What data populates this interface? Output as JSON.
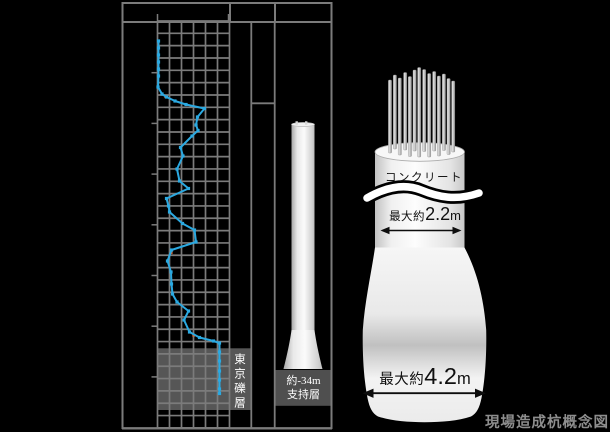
{
  "canvas": {
    "width": 610,
    "height": 432,
    "background": "#000000"
  },
  "colors": {
    "grid_gray": "#7b7b7b",
    "line_blue": "#2BA9E1",
    "red_mark_orange": "#D9622B",
    "layer_band_gray": "#565656",
    "support_box_gray": "#4f4f4f",
    "caption_gray": "#8e8e8e",
    "white": "#ffffff",
    "black": "#000000"
  },
  "boring_log": {
    "grid": {
      "x0": 157.5,
      "x1": 229.5,
      "col_step": 12,
      "y0": 21,
      "y1": 428,
      "row_step": 12.33
    },
    "frame": {
      "lines": [
        [
          122,
          3,
          332,
          3,
          2
        ],
        [
          122,
          22,
          332,
          22,
          2
        ],
        [
          122.5,
          2,
          122.5,
          429,
          2
        ],
        [
          331.5,
          2,
          331.5,
          429,
          2
        ],
        [
          122,
          428.3,
          332,
          428.3,
          2.4
        ],
        [
          230,
          2,
          230,
          22,
          2
        ],
        [
          275,
          2,
          275,
          22,
          2
        ],
        [
          251.3,
          22,
          251.3,
          428,
          1.8
        ],
        [
          274.7,
          22,
          274.7,
          428,
          1.8
        ],
        [
          251.3,
          103.3,
          274.7,
          103.3,
          1.8
        ]
      ],
      "header_ticks_x": [
        157.5,
        228.5
      ],
      "left_ticks_y": [
        72.7,
        123.4,
        174.1,
        224.8,
        275.5,
        326.2,
        376.9
      ]
    },
    "layer_band": {
      "label": "東京礫層",
      "x": 157.5,
      "y": 348.3,
      "w": 93.8,
      "h": 61.7
    },
    "support_box": {
      "line1": "約-34m",
      "line2": "支持層",
      "x": 275,
      "y": 370,
      "w": 56.5,
      "h": 35.8
    },
    "pile_column": {
      "x": 291.5,
      "w": 23,
      "top": 124.5,
      "flare_top": 330,
      "bottom": 369,
      "flare_extra": 8
    }
  },
  "chart_data": {
    "type": "line",
    "title": "",
    "description": "Borehole standard-penetration-test N-value log; depth increases downward, N value increases to the right",
    "x_axis": {
      "label": "",
      "n_value_range": [
        0,
        60
      ],
      "gridline_step_n": 10
    },
    "y_axis": {
      "label": "",
      "depth_increases_down": true,
      "major_tick_interval_m": 5
    },
    "legend": "none",
    "series": [
      {
        "name": "N値",
        "color": "#2BA9E1",
        "points_depth_m_vs_n": [
          [
            1.9,
            0.8
          ],
          [
            2.6,
            0.8
          ],
          [
            3.2,
            0.8
          ],
          [
            3.9,
            0.8
          ],
          [
            4.6,
            0.8
          ],
          [
            5.3,
            0.8
          ],
          [
            6.3,
            0.4
          ],
          [
            7.0,
            3.8
          ],
          [
            7.3,
            7.5
          ],
          [
            7.6,
            14.6
          ],
          [
            8.0,
            23.8
          ],
          [
            8.4,
            39.2
          ],
          [
            9.2,
            33.3
          ],
          [
            9.9,
            32.1
          ],
          [
            10.5,
            33.8
          ],
          [
            11.0,
            28.8
          ],
          [
            12.1,
            19.2
          ],
          [
            12.9,
            21.3
          ],
          [
            14.1,
            16.3
          ],
          [
            15.3,
            18.3
          ],
          [
            16.0,
            25.8
          ],
          [
            17.0,
            7.5
          ],
          [
            17.7,
            9.2
          ],
          [
            18.2,
            10.0
          ],
          [
            19.3,
            20.8
          ],
          [
            20.0,
            30.8
          ],
          [
            21.1,
            32.1
          ],
          [
            21.9,
            11.7
          ],
          [
            22.9,
            8.3
          ],
          [
            24.0,
            11.3
          ],
          [
            25.1,
            11.7
          ],
          [
            26.1,
            12.5
          ],
          [
            26.8,
            16.3
          ],
          [
            27.7,
            25.8
          ],
          [
            28.6,
            22.1
          ],
          [
            29.7,
            26.7
          ],
          [
            30.2,
            35.0
          ],
          [
            30.6,
            46.7
          ],
          [
            30.8,
            51.7
          ],
          [
            31.6,
            51.7
          ],
          [
            32.5,
            51.7
          ],
          [
            33.4,
            51.7
          ],
          [
            34.3,
            51.7
          ],
          [
            35.2,
            51.7
          ],
          [
            35.6,
            51.7
          ]
        ]
      }
    ],
    "pixel_points": [
      [
        158.5,
        41
      ],
      [
        158.5,
        48
      ],
      [
        158.5,
        55
      ],
      [
        158.5,
        62
      ],
      [
        158.5,
        69
      ],
      [
        158.5,
        76
      ],
      [
        158,
        87
      ],
      [
        162,
        94
      ],
      [
        166.5,
        97
      ],
      [
        175,
        101
      ],
      [
        186,
        104.5
      ],
      [
        204.5,
        108.5
      ],
      [
        197.5,
        117
      ],
      [
        196,
        125
      ],
      [
        198,
        130.5
      ],
      [
        192,
        136
      ],
      [
        180.5,
        147.5
      ],
      [
        183,
        156
      ],
      [
        177,
        169
      ],
      [
        179.5,
        181
      ],
      [
        188.5,
        188.5
      ],
      [
        166.5,
        198.5
      ],
      [
        168.5,
        206
      ],
      [
        169.5,
        212
      ],
      [
        182.5,
        223.5
      ],
      [
        194.5,
        230
      ],
      [
        196,
        242
      ],
      [
        171.5,
        250
      ],
      [
        167.5,
        261
      ],
      [
        171,
        272
      ],
      [
        171.5,
        284
      ],
      [
        172.5,
        294
      ],
      [
        177,
        302
      ],
      [
        188.5,
        311
      ],
      [
        184,
        320
      ],
      [
        189.5,
        332
      ],
      [
        199.5,
        337.5
      ],
      [
        213.5,
        341
      ],
      [
        219.5,
        343
      ],
      [
        219.5,
        352
      ],
      [
        219.5,
        361
      ],
      [
        219.5,
        371
      ],
      [
        219.5,
        380
      ],
      [
        219.5,
        389
      ],
      [
        219.5,
        393.5
      ]
    ],
    "red_marks_px": [
      [
        165.5,
        96.5
      ],
      [
        171,
        252.5
      ],
      [
        170.5,
        272
      ],
      [
        193.5,
        335
      ]
    ],
    "annotations": [
      {
        "text": "東京礫層",
        "meaning": "Tokyo gravel layer band"
      },
      {
        "text": "約-34m 支持層",
        "meaning": "bearing stratum at approx -34 m"
      }
    ]
  },
  "pile_figure": {
    "labels": {
      "concrete": "コンクリート",
      "top_width": {
        "prefix": "最大約",
        "value": "2.2",
        "unit": "m"
      },
      "bottom_width": {
        "prefix": "最大約",
        "value": "4.2",
        "unit": "m"
      }
    },
    "cylinder": {
      "x": 375,
      "w": 89.5,
      "face_cy": 152,
      "face_ry": 9.3,
      "bottom": 248.5
    },
    "bell": {
      "top_y": 247.5,
      "max_left": 362.8,
      "max_right": 486.2,
      "bottom_y": 422.2
    },
    "arrows": {
      "top": {
        "x1": 380.5,
        "x2": 461.5,
        "y": 230.5,
        "w": 1.6,
        "head": 9
      },
      "bottom": {
        "x1": 362.5,
        "x2": 486,
        "y": 393.2,
        "w": 1.8,
        "head": 11
      }
    },
    "rebars": [
      {
        "x": 390.0,
        "t": 80.0,
        "b": 153
      },
      {
        "x": 394.9,
        "t": 75.0,
        "b": 149
      },
      {
        "x": 399.8,
        "t": 78.0,
        "b": 155
      },
      {
        "x": 405.2,
        "t": 72.5,
        "b": 150
      },
      {
        "x": 409.9,
        "t": 76.5,
        "b": 156.5
      },
      {
        "x": 414.6,
        "t": 70.0,
        "b": 151
      },
      {
        "x": 419.2,
        "t": 67.5,
        "b": 157
      },
      {
        "x": 424.2,
        "t": 69.5,
        "b": 151.5
      },
      {
        "x": 429.2,
        "t": 73.5,
        "b": 157
      },
      {
        "x": 434.2,
        "t": 71.5,
        "b": 151
      },
      {
        "x": 438.9,
        "t": 76.0,
        "b": 156
      },
      {
        "x": 443.9,
        "t": 74.0,
        "b": 150.5
      },
      {
        "x": 448.6,
        "t": 78.5,
        "b": 154.5
      },
      {
        "x": 453.2,
        "t": 81.0,
        "b": 152
      }
    ]
  },
  "caption": {
    "text": "現場造成杭概念図"
  }
}
